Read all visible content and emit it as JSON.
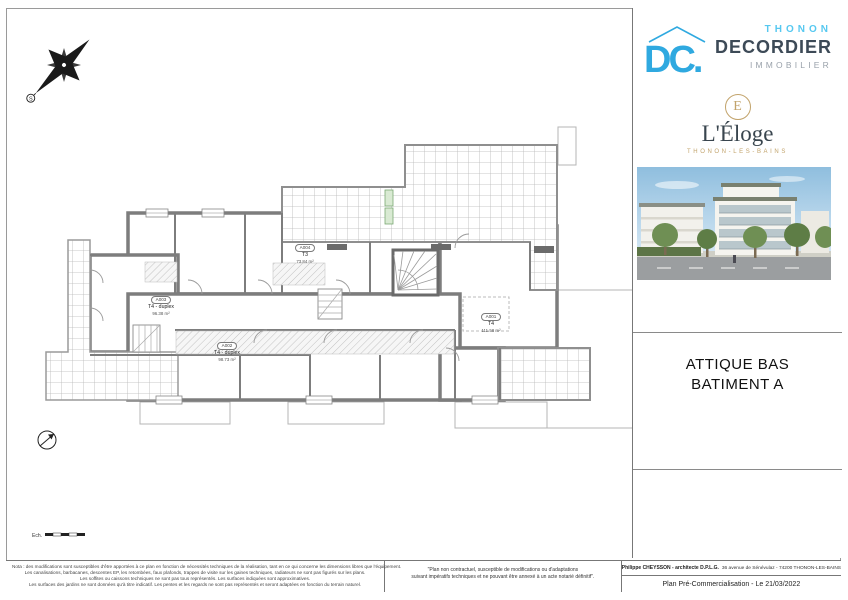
{
  "branding": {
    "agency": {
      "city": "THONON",
      "name": "DECORDIER",
      "field": "IMMOBILIER",
      "mark": "DC."
    },
    "project": {
      "monogram": "E",
      "name": "L'Éloge",
      "city": "THONON-LES-BAINS"
    }
  },
  "plan_title": {
    "line1": "ATTIQUE BAS",
    "line2": "BATIMENT A"
  },
  "apartments": [
    {
      "ref": "A004",
      "type": "T3",
      "area": "73.84 m²"
    },
    {
      "ref": "A003",
      "type": "T4 - duplex",
      "area": "96.38 m²"
    },
    {
      "ref": "A002",
      "type": "T4 - duplex",
      "area": "98.73 m²"
    },
    {
      "ref": "A001",
      "type": "T4",
      "area": "111.58 m²"
    }
  ],
  "compass": {
    "south": "S"
  },
  "scale": {
    "label": "Ech."
  },
  "notes": {
    "line1": "Nota : des modifications sont susceptibles d'être apportées à ce plan en fonction de nécessités techniques de la réalisation, tant en ce qui concerne les dimensions libres que l'équipement.",
    "line2": "Les canalisations, barbacanes, descentes EP, les retombées, faux plafonds, trappes de visite sur les gaines techniques, radiateurs ne sont pas figurés sur les plans.",
    "line3": "Les soffites ou caissons techniques ne sont pas tous représentés. Les surfaces indiquées sont approximatives.",
    "line4": "Les surfaces des jardins ne sont données qu'à titre indicatif. Les pentes et les regards ne sont pas représentés et seront adaptées en fonction du terrain naturel."
  },
  "disclaimer": {
    "line1": "\"Plan non contractuel, susceptible de modifications ou d'adaptations",
    "line2": "suivant impératifs techniques et ne pouvant être annexé à un acte notarié définitif\"."
  },
  "titleblock": {
    "architect": "Philippe CHEYSSON - architecte D.P.L.G.",
    "address": "36 avenue de Sénévulaz - 74200 THONON-LES-BAINS",
    "status": "Plan Pré-Commercialisation - Le 21/03/2022"
  },
  "colors": {
    "accent_blue": "#2fa9e0",
    "light_blue": "#56c8f0",
    "dark_text": "#3d4a57",
    "gold": "#c2a36b",
    "wall_gray": "#7d7d7d"
  }
}
